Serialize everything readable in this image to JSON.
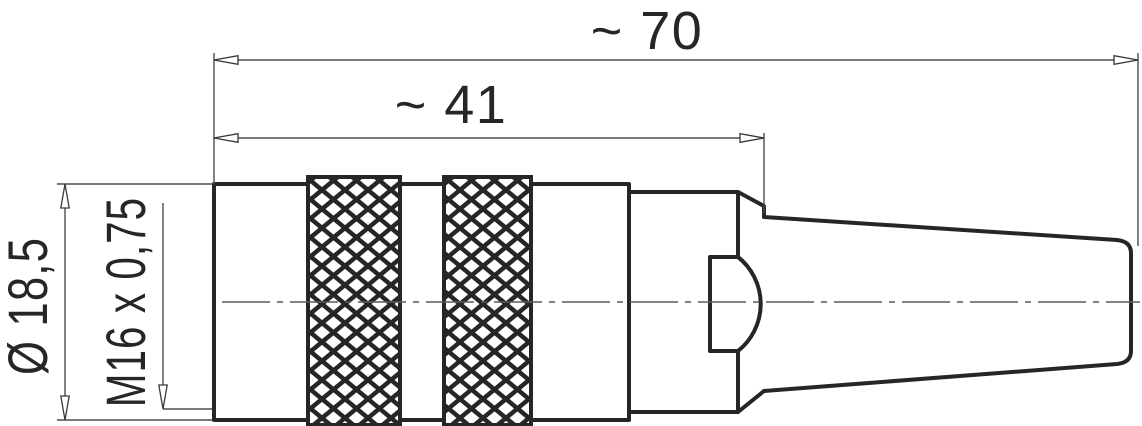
{
  "drawing": {
    "dimensions": {
      "overall_length": "~ 70",
      "body_length": "~ 41",
      "diameter": "Ø 18,5",
      "thread": "M16 x 0,75"
    },
    "colors": {
      "outline": "#262626",
      "dimension_lines": "#4d4d4d",
      "background": "#ffffff"
    }
  }
}
